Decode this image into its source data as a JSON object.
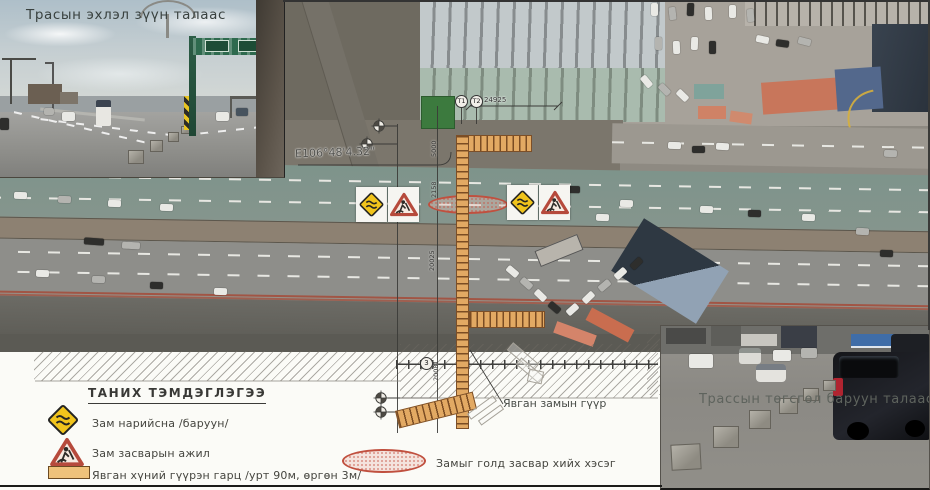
{
  "sheet": {
    "photos": {
      "top_left_caption": "Трасын эхлэл зүүн талаас",
      "bottom_right_caption": "Трассын төгсгөл баруун талаас"
    },
    "plan": {
      "gps_label": "Е106°48'4.32\"",
      "bridge_callout": "Явган замын гүүр",
      "markers": {
        "t1": "Т1",
        "t2": "Т2",
        "node": "3"
      },
      "dimensions": {
        "span_top": "24925",
        "v1": "5000",
        "v2": "2158",
        "v3": "20025",
        "v4": "20081"
      }
    },
    "legend": {
      "title": "ТАНИХ ТЭМДЭГЛЭГЭЭ",
      "items": [
        {
          "icon": "road-narrows-sign",
          "label": "Зам нарийсна /баруун/"
        },
        {
          "icon": "road-work-sign",
          "label": "Зам засварын ажил"
        },
        {
          "icon": "pedestrian-overpass-swatch",
          "label": "Явган хүний гүүрэн гарц /урт 90м, өргөн 3м/"
        },
        {
          "icon": "median-repair-ellipse",
          "label": "Замыг голд засвар хийх хэсэг"
        }
      ]
    },
    "colors": {
      "sign_yellow": "#f1c41c",
      "sign_red": "#b64a3c",
      "bridge_tan": "#e2a963",
      "repair_pink": "#ecc1b7",
      "aerial_gray": "#96928a"
    }
  }
}
